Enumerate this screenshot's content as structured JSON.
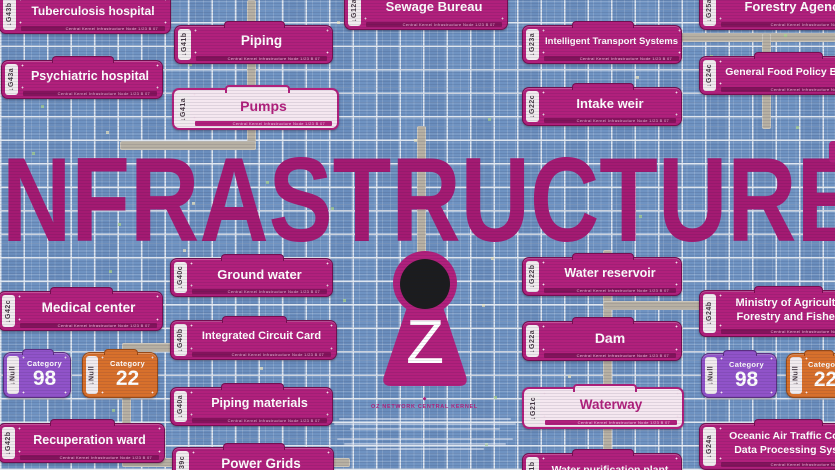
{
  "title": "INFRASTRUCTURE",
  "kernel": {
    "letter": "Z",
    "caption": "OZ NETWORK CENTRAL KERNEL"
  },
  "icons": {
    "tag_arrow": "↓",
    "kernel_mark": "◆"
  },
  "sign_footer": "Central Kernel Infrastructure Node   1/23 B 07",
  "signs": [
    {
      "id": "tuberculosis-hospital",
      "tag": "G43b",
      "label": "Tuberculosis hospital",
      "style": "magenta",
      "x": -1,
      "y": -6,
      "w": 170,
      "h": 38,
      "fs": 12
    },
    {
      "id": "piping",
      "tag": "G41b",
      "label": "Piping",
      "style": "magenta",
      "x": 174,
      "y": 25,
      "w": 157,
      "h": 37,
      "fs": 13.5
    },
    {
      "id": "psychiatric-hospital",
      "tag": "G43a",
      "label": "Psychiatric hospital",
      "style": "magenta",
      "x": 1,
      "y": 60,
      "w": 160,
      "h": 37,
      "fs": 12.5
    },
    {
      "id": "pumps",
      "tag": "G41a",
      "label": "Pumps",
      "style": "white",
      "x": 172,
      "y": 88,
      "w": 163,
      "h": 38,
      "fs": 14
    },
    {
      "id": "sewage-bureau",
      "tag": "G12a",
      "label": "Sewage Bureau",
      "style": "magenta",
      "x": 344,
      "y": -10,
      "w": 162,
      "h": 38,
      "fs": 13
    },
    {
      "id": "intelligent-transport-systems",
      "tag": "G23a",
      "label": "Intelligent Transport Systems",
      "style": "magenta",
      "x": 522,
      "y": 25,
      "w": 158,
      "h": 37,
      "fs": 9.5
    },
    {
      "id": "forestry-agency",
      "tag": "G25a",
      "label": "Forestry Agency",
      "style": "magenta",
      "x": 699,
      "y": -10,
      "w": 175,
      "h": 38,
      "fs": 13
    },
    {
      "id": "general-food-policy-bureau",
      "tag": "G24c",
      "label": "General Food Policy Bureau",
      "style": "magenta",
      "x": 699,
      "y": 56,
      "w": 175,
      "h": 37,
      "fs": 10.5
    },
    {
      "id": "intake-weir",
      "tag": "G22c",
      "label": "Intake weir",
      "style": "magenta",
      "x": 522,
      "y": 87,
      "w": 158,
      "h": 37,
      "fs": 13
    },
    {
      "id": "ground-water",
      "tag": "G40c",
      "label": "Ground water",
      "style": "magenta",
      "x": 170,
      "y": 258,
      "w": 161,
      "h": 37,
      "fs": 13
    },
    {
      "id": "integrated-circuit-card",
      "tag": "G40b",
      "label": "Integrated Circuit Card",
      "style": "magenta",
      "x": 170,
      "y": 320,
      "w": 165,
      "h": 38,
      "fs": 11
    },
    {
      "id": "piping-materials",
      "tag": "G40a",
      "label": "Piping materials",
      "style": "magenta",
      "x": 170,
      "y": 387,
      "w": 161,
      "h": 37,
      "fs": 12.5
    },
    {
      "id": "medical-center",
      "tag": "G42c",
      "label": "Medical center",
      "style": "magenta",
      "x": -2,
      "y": 291,
      "w": 163,
      "h": 38,
      "fs": 13.5
    },
    {
      "id": "recuperation-ward",
      "tag": "G42b",
      "label": "Recuperation ward",
      "style": "magenta",
      "x": -2,
      "y": 423,
      "w": 165,
      "h": 38,
      "fs": 12.5
    },
    {
      "id": "power-grids",
      "tag": "G39c",
      "label": "Power Grids",
      "style": "magenta",
      "x": 172,
      "y": 447,
      "w": 160,
      "h": 38,
      "fs": 13.5
    },
    {
      "id": "water-reservoir",
      "tag": "G22b",
      "label": "Water reservoir",
      "style": "magenta",
      "x": 522,
      "y": 257,
      "w": 158,
      "h": 37,
      "fs": 12.5
    },
    {
      "id": "dam",
      "tag": "G22a",
      "label": "Dam",
      "style": "magenta",
      "x": 522,
      "y": 321,
      "w": 158,
      "h": 38,
      "fs": 14
    },
    {
      "id": "waterway",
      "tag": "G21c",
      "label": "Waterway",
      "style": "white",
      "x": 522,
      "y": 387,
      "w": 158,
      "h": 38,
      "fs": 13.5
    },
    {
      "id": "water-purification-plant",
      "tag": "G21b",
      "label": "Water purification plant",
      "style": "magenta",
      "x": 522,
      "y": 453,
      "w": 158,
      "h": 38,
      "fs": 10.5
    },
    {
      "id": "ministry-of-agriculture",
      "tag": "G24b",
      "label": "Ministry of Agriculture,",
      "label2": "Forestry and Fisheries",
      "style": "magenta",
      "x": 699,
      "y": 290,
      "w": 175,
      "h": 45,
      "fs": 11
    },
    {
      "id": "oceanic-air-traffic-control",
      "tag": "G24a",
      "label": "Oceanic Air Traffic Control",
      "label2": "Data Processing System",
      "style": "magenta",
      "x": 699,
      "y": 423,
      "w": 175,
      "h": 45,
      "fs": 10.5
    }
  ],
  "badges": [
    {
      "id": "category-98-left",
      "tag": "Null",
      "label": "Category",
      "value": "98",
      "color": "purple",
      "x": 3,
      "y": 352,
      "w": 66,
      "h": 44
    },
    {
      "id": "category-22-left",
      "tag": "Null",
      "label": "Category",
      "value": "22",
      "color": "orange",
      "x": 82,
      "y": 352,
      "w": 74,
      "h": 44
    },
    {
      "id": "category-98-right",
      "tag": "Null",
      "label": "Category",
      "value": "98",
      "color": "purple",
      "x": 701,
      "y": 353,
      "w": 74,
      "h": 43
    },
    {
      "id": "category-22-right",
      "tag": "Null",
      "label": "Category",
      "value": "22",
      "color": "orange",
      "x": 786,
      "y": 353,
      "w": 62,
      "h": 43
    }
  ],
  "colors": {
    "sign_magenta": "#b1207c",
    "sign_white_bg": "#f5e7f0",
    "tag_bg": "#f1ebee",
    "tag_fg": "#473a44",
    "badge_purple": "#9153c9",
    "badge_orange": "#d8702c",
    "title_magenta": "#a41a72",
    "map_blue": "#6f93c2",
    "road_gray": "#b7b0a3",
    "kernel_black": "#1c1c1e"
  }
}
